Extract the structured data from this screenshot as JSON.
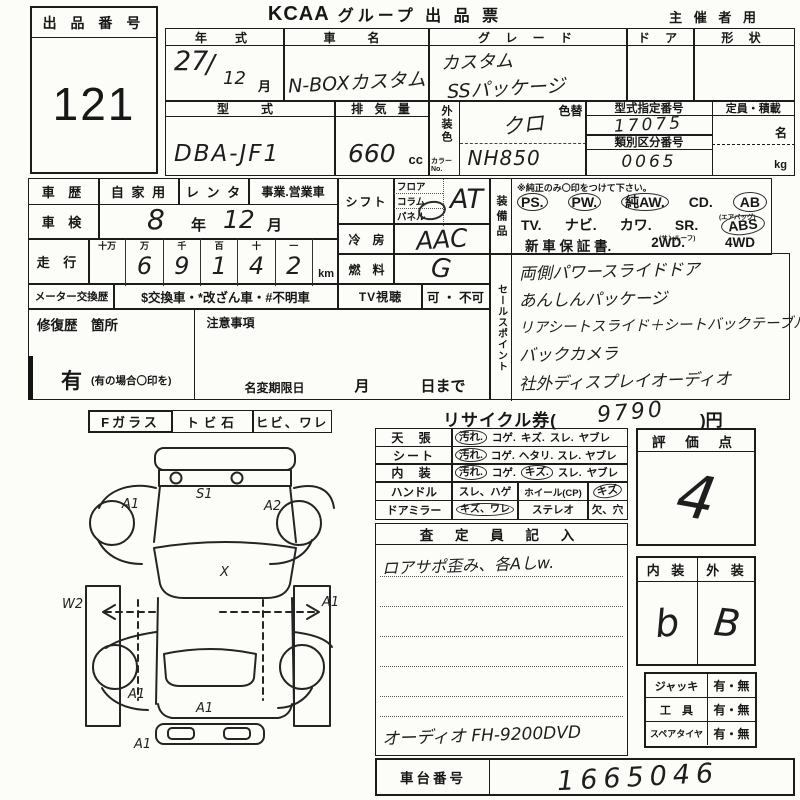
{
  "header": {
    "auction_label": "出 品 番 号",
    "auction_no": "121",
    "brand": "KCAA",
    "title": "グループ 出 品 票",
    "organizer": "主 催 者 用"
  },
  "vehicle": {
    "year_label": "年　式",
    "year": "27",
    "slash": "/",
    "month": "12",
    "month_unit": "月",
    "name_label": "車　名",
    "name": "N-BOXカスタム",
    "grade_label": "グ レ ー ド",
    "grade1": "カスタム",
    "grade2": "SSパッケージ",
    "door_label": "ド ア",
    "shape_label": "形 状",
    "model_label": "型　式",
    "model": "DBA-JF1",
    "disp_label": "排 気 量",
    "disp": "660",
    "disp_unit": "cc",
    "color_label": "外装色",
    "color_no_label": "カラーNo.",
    "color_change": "色替",
    "color": "クロ",
    "color_no": "NH850",
    "type_no_label": "型式指定番号",
    "type_no": "17075",
    "class_no_label": "類別区分番号",
    "class_no": "0065",
    "capacity_label": "定員・積載",
    "capacity_person_unit": "名",
    "capacity_weight_unit": "kg"
  },
  "history": {
    "label": "車 歴",
    "opt_private": "自 家 用",
    "opt_rental": "レ ン タ",
    "opt_business": "事業.営業車",
    "inspection_label": "車 検",
    "inspection_year": "8",
    "inspection_year_unit": "年",
    "inspection_month": "12",
    "inspection_month_unit": "月",
    "mileage_label": "走 行",
    "digit_units": [
      "十万",
      "万",
      "千",
      "百",
      "十",
      "一"
    ],
    "digits": [
      "",
      "6",
      "9",
      "1",
      "4",
      "2"
    ],
    "mileage_unit": "km",
    "meter_label": "メーター交換歴",
    "meter_note": "$交換車・*改ざん車・#不明車",
    "repair_label": "修復歴　箇所",
    "caution_label": "注意事項",
    "repair_yes": "有",
    "repair_hint": "(有の場合〇印を)",
    "name_change_label": "名変期限日",
    "name_change_month": "月",
    "name_change_until": "日まで"
  },
  "specs": {
    "shift_label": "シフト",
    "shift_opts": [
      "フロア",
      "コラム",
      "パネル"
    ],
    "shift": "AT",
    "ac_label": "冷　房",
    "ac": "AAC",
    "fuel_label": "燃　料",
    "fuel": "G",
    "tv_label": "TV視聴",
    "tv": "可 ・ 不可"
  },
  "equipment": {
    "label": "装備品",
    "note": "※純正のみ〇印をつけて下さい。",
    "row1": [
      "PS.",
      "PW.",
      "純AW.",
      "CD.",
      "AB"
    ],
    "airbag_note": "(エアバッグ)",
    "row2": [
      "TV.",
      "ナビ.",
      "カワ.",
      "SR.",
      "ABS"
    ],
    "sunroof_note": "(サンルーフ)",
    "row3": [
      "新 車 保 証 書.",
      "2WD.",
      "4WD"
    ]
  },
  "sales": {
    "label": "セールスポイント",
    "items": [
      "両側パワースライドドア",
      "あんしんパッケージ",
      "リアシートスライド＋シートバックテーブル",
      "バックカメラ",
      "社外ディスプレイオーディオ"
    ]
  },
  "recycle": {
    "prefix": "リサイクル券(",
    "amount": "9790",
    "suffix": ")円"
  },
  "condition": {
    "r1": {
      "label": "天 張",
      "o1": "汚れ.",
      "o2": "コゲ.",
      "o3": "キズ.",
      "o4": "スレ.",
      "o5": "ヤブレ"
    },
    "r2": {
      "label": "シート",
      "o1": "汚れ.",
      "o2": "コゲ.",
      "o3": "ヘタリ.",
      "o4": "スレ.",
      "o5": "ヤブレ"
    },
    "r3": {
      "label": "内 装",
      "o1": "汚れ.",
      "o2": "コゲ.",
      "o3": "キズ.",
      "o4": "スレ.",
      "o5": "ヤブレ"
    },
    "r4": {
      "label": "ハンドル",
      "o1": "スレ、ハゲ",
      "label2": "ホイール(CP)",
      "o2": "キズ"
    },
    "r5": {
      "label": "ドアミラー",
      "o1": "キズ、ワレ",
      "label2": "ステレオ",
      "o2": "欠、穴"
    }
  },
  "assessor": {
    "header": "査 定 員 記 入",
    "line1": "ロアサポ歪み、各Aしw.",
    "audio_line": "オーディオ FH-9200DVD"
  },
  "rating": {
    "label": "評 価 点",
    "score": "4",
    "interior_label": "内 装",
    "exterior_label": "外 装",
    "interior": "b",
    "exterior": "B"
  },
  "accessories": {
    "jack_label": "ジャッキ",
    "jack": "有・無",
    "tools_label": "工　具",
    "tools": "有・無",
    "spare_label": "スペアタイヤ",
    "spare": "有・無"
  },
  "chassis": {
    "label": "車台番号",
    "number": "1665046"
  },
  "glass": {
    "label": "Fガラス",
    "o1": "トビ石",
    "o2": "ヒビ、ワレ"
  },
  "diagram": {
    "labels": {
      "front_left": "A1",
      "hood": "S1",
      "front_right": "A2",
      "left_side": "W2",
      "windshield": "X",
      "right_side": "A1",
      "rear_left": "A1",
      "tailgate": "A1",
      "rear_bumper": "A1"
    }
  }
}
